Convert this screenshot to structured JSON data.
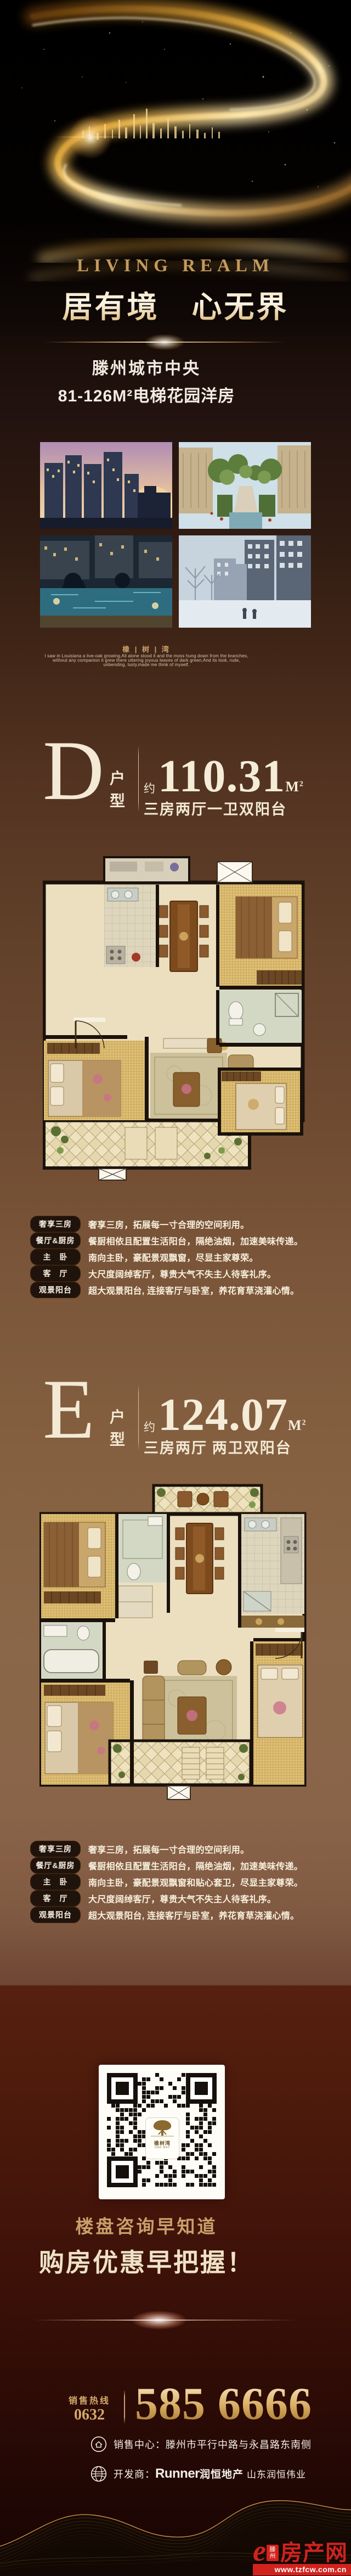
{
  "hero": {
    "tagline": "LIVING REALM",
    "title": "居有境　心无界"
  },
  "intro": {
    "line1": "滕州城市中央",
    "line2": "81-126M²电梯花园洋房"
  },
  "brand": {
    "name": "橡 | 树 | 湾",
    "poem1": "I saw in Louisiana a live-oak growing,All alone stood it and the moss hung down from the branches,",
    "poem2": "without any companion it grew there uttering joyous leaves of dark green,And its look, rude,",
    "poem3": "unbending, lusty,made me think of myself."
  },
  "units": {
    "d": {
      "letter": "D",
      "type": "户型",
      "approx": "约",
      "area": "110.31",
      "unit": "M",
      "unit_sup": "2",
      "rooms": "三房两厅一卫双阳台",
      "features": [
        {
          "label": "奢享三房",
          "text": "奢享三房，拓展每一寸合理的空间利用。"
        },
        {
          "label": "餐厅&厨房",
          "text": "餐厨相依且配置生活阳台，隔绝油烟，加速美味传递。"
        },
        {
          "label": "主　卧",
          "text": "南向主卧，豪配景观飘窗，尽显主家尊荣。"
        },
        {
          "label": "客　厅",
          "text": "大尺度阔绰客厅，尊贵大气不失主人待客礼序。"
        },
        {
          "label": "观景阳台",
          "text": "超大观景阳台, 连接客厅与卧室，养花育草浇灌心情。"
        }
      ]
    },
    "e": {
      "letter": "E",
      "type": "户型",
      "approx": "约",
      "area": "124.07",
      "unit": "M",
      "unit_sup": "2",
      "rooms": "三房两厅 两卫双阳台",
      "features": [
        {
          "label": "奢享三房",
          "text": "奢享三房，拓展每一寸合理的空间利用。"
        },
        {
          "label": "餐厅&厨房",
          "text": "餐厨相依且配置生活阳台，隔绝油烟，加速美味传递。"
        },
        {
          "label": "主　卧",
          "text": "南向主卧，豪配景观飘窗和贴心套卫，尽显主家尊荣。"
        },
        {
          "label": "客　厅",
          "text": "大尺度阔绰客厅，尊贵大气不失主人待客礼序。"
        },
        {
          "label": "观景阳台",
          "text": "超大观景阳台, 连接客厅与卧室，养花育草浇灌心情。"
        }
      ]
    }
  },
  "qr": {
    "name": "橡树湾",
    "sub": "OAK BAY"
  },
  "promo": {
    "line1": "楼盘咨询早知道",
    "line2": "购房优惠早把握！"
  },
  "hotline": {
    "label": "销售热线",
    "code": "0632",
    "number": "585 6666"
  },
  "contacts": {
    "sales_label": "销售中心：",
    "sales_text": "滕州市平行中路与永昌路东南侧",
    "dev_label": "开发商：",
    "dev_brand": "Runner",
    "dev_brand_cn": "润恒地产",
    "dev_company": "山东润恒伟业"
  },
  "site": {
    "mark": "e",
    "city": "滕州",
    "name": "房产网",
    "url": "www.tzfcw.com.cn"
  },
  "colors": {
    "gold": "#c9a065",
    "cream": "#f3e9d5",
    "red": "#d2221e"
  }
}
